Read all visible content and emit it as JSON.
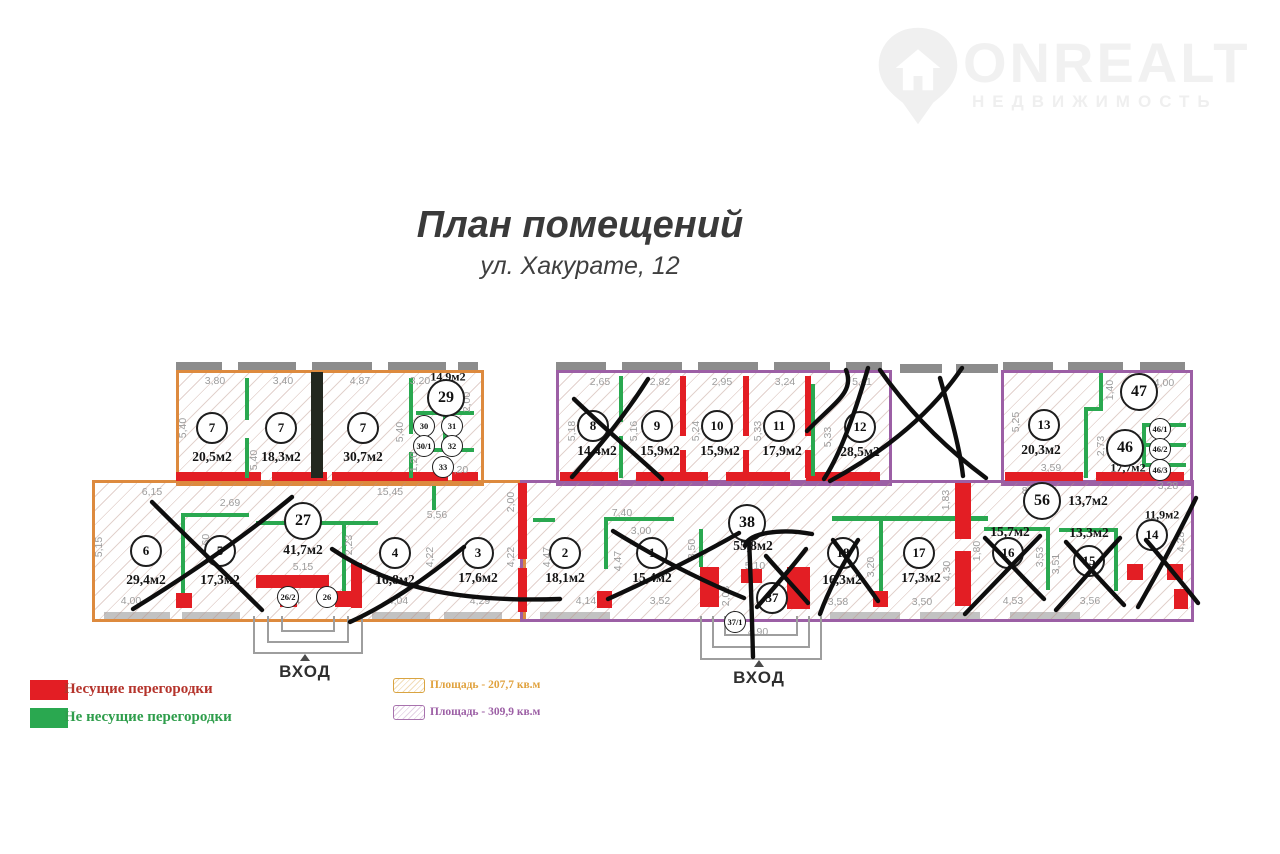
{
  "logo": {
    "brand": "ONREALT",
    "tagline": "НЕДВИЖИМОСТЬ"
  },
  "header": {
    "title": "План помещений",
    "subtitle": "ул. Хакурате, 12"
  },
  "entrances": {
    "label1": "ВХОД",
    "label2": "ВХОД"
  },
  "legend": {
    "bearing": {
      "label": "Несущие перегородки",
      "color": "#e31e24"
    },
    "non_bearing": {
      "label": "Не несущие перегородки",
      "color": "#2aa850"
    },
    "area_orange": {
      "label": "Площадь - 207,7 кв.м",
      "color": "#e0a23e"
    },
    "area_purple": {
      "label": "Площадь - 309,9 кв.м",
      "color": "#9c5fa5"
    }
  },
  "colors": {
    "orange_outline": "#dd8a3e",
    "purple_outline": "#9c5fa5",
    "bearing_red": "#e31e24",
    "non_bearing_green": "#2aa850",
    "wall_gray": "#8c8c8c"
  },
  "rooms": {
    "7a": {
      "num": "7",
      "area": "20,5м2"
    },
    "7b": {
      "num": "7",
      "area": "18,3м2"
    },
    "7c": {
      "num": "7",
      "area": "30,7м2"
    },
    "29": {
      "num": "29",
      "area": "14,9м2"
    },
    "30": {
      "num": "30"
    },
    "31": {
      "num": "31"
    },
    "30_1": {
      "num": "30/1"
    },
    "32": {
      "num": "32"
    },
    "33": {
      "num": "33"
    },
    "6": {
      "num": "6",
      "area": "29,4м2"
    },
    "5": {
      "num": "5",
      "area": "17,3м2"
    },
    "27": {
      "num": "27",
      "area": "41,7м2"
    },
    "4": {
      "num": "4",
      "area": "16,8м2"
    },
    "3": {
      "num": "3",
      "area": "17,6м2"
    },
    "26_2": {
      "num": "26/2"
    },
    "26": {
      "num": "26"
    },
    "8": {
      "num": "8",
      "area": "14,4м2"
    },
    "9": {
      "num": "9",
      "area": "15,9м2"
    },
    "10": {
      "num": "10",
      "area": "15,9м2"
    },
    "11": {
      "num": "11",
      "area": "17,9м2"
    },
    "12": {
      "num": "12",
      "area": "28,5м2"
    },
    "13": {
      "num": "13",
      "area": "20,3м2"
    },
    "47": {
      "num": "47"
    },
    "46": {
      "num": "46",
      "area": "17,7м2"
    },
    "46_1": {
      "num": "46/1"
    },
    "46_2": {
      "num": "46/2"
    },
    "46_3": {
      "num": "46/3"
    },
    "2": {
      "num": "2",
      "area": "18,1м2"
    },
    "1": {
      "num": "1",
      "area": "15,4м2"
    },
    "38": {
      "num": "38",
      "area": "55,8м2"
    },
    "37": {
      "num": "37"
    },
    "37_1": {
      "num": "37/1"
    },
    "18": {
      "num": "18",
      "area": "16,3м2"
    },
    "17": {
      "num": "17",
      "area": "17,3м2"
    },
    "56": {
      "num": "56",
      "area": "13,7м2"
    },
    "16": {
      "num": "16",
      "area": "15,7м2"
    },
    "15": {
      "num": "15",
      "area": "13,3м2"
    },
    "14": {
      "num": "14",
      "area": "11,9м2"
    }
  },
  "dims": {
    "a1": "3,80",
    "a2": "3,40",
    "a3": "4,87",
    "a4": "3,20",
    "a5": "2,00",
    "a6": "5,40",
    "a7": "5,40",
    "a8": "5,40",
    "a9": "1,20",
    "a10": "3,20",
    "b1": "6,15",
    "b2": "15,45",
    "b3": "2,69",
    "b4": "5,15",
    "b5": "4,60",
    "b6": "2,23",
    "b7": "5,15",
    "b8": "5,56",
    "b9": "4,22",
    "b10": "2,00",
    "b11": "4,22",
    "b12": "4,00",
    "b13": "3,84",
    "b14": "4,04",
    "b15": "4,29",
    "c1": "2,65",
    "c2": "2,82",
    "c3": "2,95",
    "c4": "3,24",
    "c5": "5,11",
    "c6": "5,18",
    "c7": "5,16",
    "c8": "5,24",
    "c9": "5,33",
    "c10": "5,33",
    "d1": "4,00",
    "d2": "5,25",
    "d3": "1,40",
    "d4": "2,73",
    "d5": "3,59",
    "d6": "3,28",
    "e1": "7,40",
    "e2": "3,00",
    "e3": "4,47",
    "e4": "4,14",
    "e5": "4,47",
    "e6": "3,52",
    "e7": "3,50",
    "e8": "5,10",
    "e9": "2,03",
    "e10": "4,90",
    "e11": "3,20",
    "e12": "3,58",
    "e13": "3,50",
    "e14": "4,30",
    "e15": "1,83",
    "e16": "1,80",
    "e17": "8,16",
    "e18": "3,53",
    "e19": "4,53",
    "e20": "3,51",
    "e21": "3,56",
    "e22": "4,28"
  }
}
